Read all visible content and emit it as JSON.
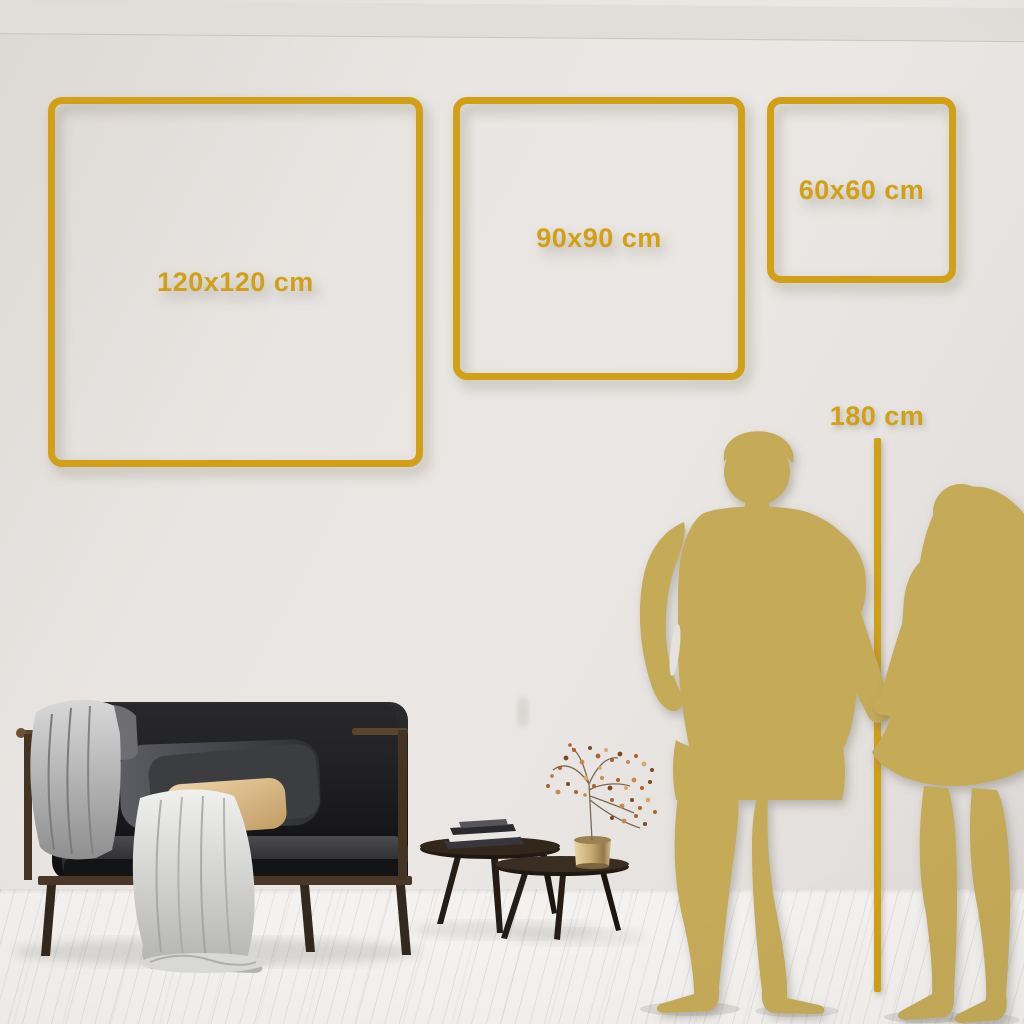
{
  "size_guide": {
    "frames": [
      {
        "id": "120",
        "label": "120x120 cm"
      },
      {
        "id": "90",
        "label": "90x90 cm"
      },
      {
        "id": "60",
        "label": "60x60 cm"
      }
    ],
    "height_reference": {
      "label": "180 cm"
    }
  },
  "colors": {
    "accent_gold": "#D2A016",
    "silhouette_gold": "#C5AA58",
    "wall": "#E7E4E1",
    "floor": "#F3F2F0",
    "wood": "#4A3729",
    "sofa_black": "#141416",
    "pillow_beige": "#DCBE90",
    "blanket_gray": "#C6C6C5",
    "vase_brass": "#C9AC76",
    "berry_rust": "#B2602B"
  },
  "scene": {
    "objects": [
      "wall",
      "wood-floor",
      "sofa",
      "throw-blanket",
      "pillows",
      "nesting-coffee-tables",
      "books",
      "brass-vase",
      "dried-plant",
      "man-silhouette",
      "woman-silhouette",
      "height-reference-line"
    ]
  }
}
